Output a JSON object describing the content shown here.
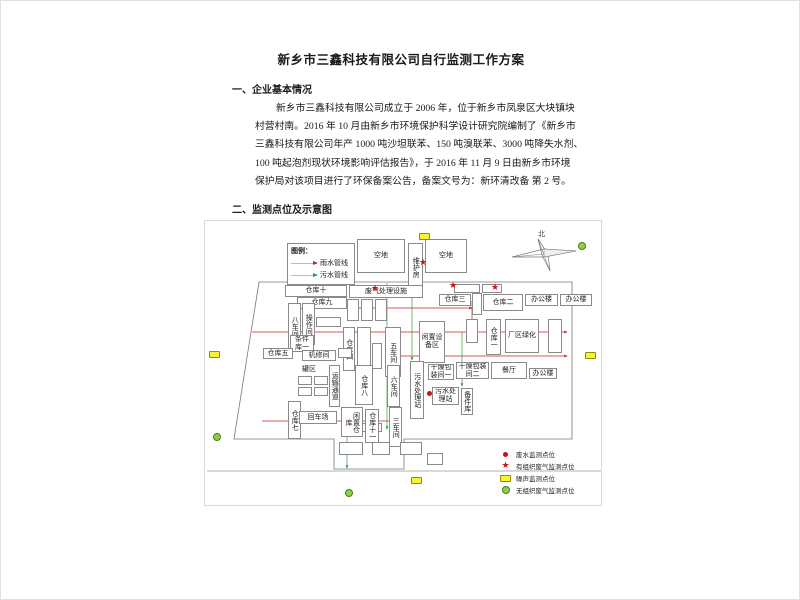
{
  "document": {
    "title": "新乡市三鑫科技有限公司自行监测工作方案",
    "section1_heading": "一、企业基本情况",
    "paragraph_lines": [
      "新乡市三鑫科技有限公司成立于 2006 年，位于新乡市凤泉区大块镇块",
      "村营村南。2016 年 10 月由新乡市环境保护科学设计研究院编制了《新乡市",
      "三鑫科技有限公司年产 1000 吨沙坦联苯、150 吨溴联苯、3000 吨降失水剂、",
      "100 吨起泡剂现状环境影响评估报告》，于 2016 年 11 月 9 日由新乡市环境",
      "保护局对该项目进行了环保备案公告，备案文号为：新环清改备 第 2 号。"
    ],
    "section2_heading": "二、监测点位及示意图"
  },
  "diagram": {
    "compass_label": "北",
    "legend_top": {
      "title": "图例：",
      "items": [
        {
          "label": "雨水管线",
          "color": "#cc2222"
        },
        {
          "label": "污水管线",
          "color": "#2f9e44"
        }
      ]
    },
    "legend_bottom": {
      "items": [
        {
          "type": "water",
          "label": "废水监测点位"
        },
        {
          "type": "org",
          "label": "有组织废气监测点位"
        },
        {
          "type": "noise",
          "label": "噪声监测点位"
        },
        {
          "type": "unorg",
          "label": "无组织废气监测点位"
        }
      ]
    },
    "colors": {
      "rain": "#cc2222",
      "sewage": "#2f9e44",
      "noise": "#f6f332",
      "unorg": "#8ed04a",
      "org": "#cc1111",
      "water": "#cc1111"
    },
    "outline": "54,61 367,61 367,218 199,218 199,248 129,248 129,218 29,218",
    "road_y": 250,
    "buildings": [
      {
        "l": "空地",
        "x": 152,
        "y": 18,
        "w": 48,
        "h": 34
      },
      {
        "l": "维护房",
        "x": 203,
        "y": 22,
        "w": 15,
        "h": 48,
        "v": 1
      },
      {
        "l": "空地",
        "x": 220,
        "y": 18,
        "w": 42,
        "h": 34
      },
      {
        "l": "仓库十",
        "x": 80,
        "y": 64,
        "w": 62,
        "h": 12
      },
      {
        "l": "废气处理设施",
        "x": 144,
        "y": 64,
        "w": 74,
        "h": 13
      },
      {
        "l": "",
        "x": 249,
        "y": 63,
        "w": 26,
        "h": 9
      },
      {
        "l": "",
        "x": 277,
        "y": 63,
        "w": 20,
        "h": 9
      },
      {
        "l": "仓库九",
        "x": 92,
        "y": 76,
        "w": 50,
        "h": 12
      },
      {
        "l": "仓库三",
        "x": 234,
        "y": 73,
        "w": 32,
        "h": 12
      },
      {
        "l": "",
        "x": 267,
        "y": 72,
        "w": 10,
        "h": 22,
        "v": 1
      },
      {
        "l": "仓库二",
        "x": 278,
        "y": 73,
        "w": 40,
        "h": 17
      },
      {
        "l": "办公楼",
        "x": 320,
        "y": 73,
        "w": 33,
        "h": 12
      },
      {
        "l": "办公楼",
        "x": 355,
        "y": 73,
        "w": 32,
        "h": 12
      },
      {
        "l": "八车间",
        "x": 83,
        "y": 82,
        "w": 13,
        "h": 46,
        "v": 1
      },
      {
        "l": "操作间",
        "x": 97,
        "y": 82,
        "w": 13,
        "h": 42,
        "v": 1
      },
      {
        "l": "",
        "x": 111,
        "y": 96,
        "w": 25,
        "h": 10
      },
      {
        "l": "",
        "x": 142,
        "y": 78,
        "w": 12,
        "h": 22
      },
      {
        "l": "",
        "x": 156,
        "y": 78,
        "w": 12,
        "h": 22
      },
      {
        "l": "",
        "x": 170,
        "y": 78,
        "w": 12,
        "h": 22
      },
      {
        "l": "仓库四",
        "x": 138,
        "y": 106,
        "w": 12,
        "h": 44,
        "v": 1
      },
      {
        "l": "",
        "x": 152,
        "y": 106,
        "w": 14,
        "h": 44,
        "v": 1
      },
      {
        "l": "五车间",
        "x": 180,
        "y": 106,
        "w": 16,
        "h": 50,
        "v": 1
      },
      {
        "l": "",
        "x": 167,
        "y": 122,
        "w": 10,
        "h": 26,
        "v": 1
      },
      {
        "l": "闲置设备区",
        "x": 214,
        "y": 100,
        "w": 26,
        "h": 42
      },
      {
        "l": "仓库一",
        "x": 281,
        "y": 98,
        "w": 15,
        "h": 36,
        "v": 1
      },
      {
        "l": "厂区绿化",
        "x": 300,
        "y": 98,
        "w": 34,
        "h": 34
      },
      {
        "l": "",
        "x": 261,
        "y": 98,
        "w": 12,
        "h": 24,
        "v": 1
      },
      {
        "l": "",
        "x": 343,
        "y": 98,
        "w": 14,
        "h": 34,
        "v": 1
      },
      {
        "l": "条件库一",
        "x": 85,
        "y": 114,
        "w": 24,
        "h": 17
      },
      {
        "l": "仓库五",
        "x": 58,
        "y": 127,
        "w": 30,
        "h": 11
      },
      {
        "l": "机修间",
        "x": 97,
        "y": 129,
        "w": 34,
        "h": 11
      },
      {
        "l": "",
        "x": 133,
        "y": 127,
        "w": 14,
        "h": 10
      },
      {
        "l": "罐区",
        "x": 93,
        "y": 144,
        "w": 22,
        "h": 10,
        "p": 1
      },
      {
        "l": "",
        "x": 93,
        "y": 155,
        "w": 14,
        "h": 9
      },
      {
        "l": "",
        "x": 109,
        "y": 155,
        "w": 14,
        "h": 9
      },
      {
        "l": "",
        "x": 93,
        "y": 166,
        "w": 14,
        "h": 9
      },
      {
        "l": "",
        "x": 109,
        "y": 166,
        "w": 14,
        "h": 9
      },
      {
        "l": "运输通道",
        "x": 124,
        "y": 144,
        "w": 11,
        "h": 42,
        "v": 1
      },
      {
        "l": "仓库八",
        "x": 150,
        "y": 144,
        "w": 18,
        "h": 40,
        "v": 1
      },
      {
        "l": "六车间",
        "x": 182,
        "y": 144,
        "w": 13,
        "h": 42,
        "v": 1
      },
      {
        "l": "污水处理站",
        "x": 205,
        "y": 140,
        "w": 14,
        "h": 58,
        "v": 1
      },
      {
        "l": "干燥包装间一",
        "x": 223,
        "y": 143,
        "w": 26,
        "h": 16
      },
      {
        "l": "干燥包装间二",
        "x": 251,
        "y": 141,
        "w": 33,
        "h": 17
      },
      {
        "l": "餐厅",
        "x": 286,
        "y": 141,
        "w": 36,
        "h": 17
      },
      {
        "l": "办公楼",
        "x": 324,
        "y": 147,
        "w": 28,
        "h": 11
      },
      {
        "l": "污水处理站",
        "x": 227,
        "y": 166,
        "w": 27,
        "h": 18
      },
      {
        "l": "备件库",
        "x": 256,
        "y": 167,
        "w": 12,
        "h": 27,
        "v": 1
      },
      {
        "l": "仓库七",
        "x": 83,
        "y": 180,
        "w": 13,
        "h": 38,
        "v": 1
      },
      {
        "l": "回车场",
        "x": 94,
        "y": 190,
        "w": 38,
        "h": 13
      },
      {
        "l": "",
        "x": 147,
        "y": 202,
        "w": 30,
        "h": 9
      },
      {
        "l": "闲置仓库",
        "x": 136,
        "y": 186,
        "w": 22,
        "h": 30,
        "v": 1
      },
      {
        "l": "仓库十一",
        "x": 160,
        "y": 188,
        "w": 14,
        "h": 34,
        "v": 1
      },
      {
        "l": "三车间",
        "x": 184,
        "y": 186,
        "w": 13,
        "h": 40,
        "v": 1
      },
      {
        "l": "",
        "x": 134,
        "y": 221,
        "w": 24,
        "h": 13
      },
      {
        "l": "",
        "x": 167,
        "y": 221,
        "w": 18,
        "h": 13
      },
      {
        "l": "",
        "x": 195,
        "y": 221,
        "w": 22,
        "h": 13
      },
      {
        "l": "",
        "x": 222,
        "y": 232,
        "w": 16,
        "h": 12
      }
    ],
    "markers": [
      {
        "t": "noise",
        "x": 214,
        "y": 12
      },
      {
        "t": "noise",
        "x": 4,
        "y": 130
      },
      {
        "t": "noise",
        "x": 380,
        "y": 131
      },
      {
        "t": "noise",
        "x": 206,
        "y": 256
      },
      {
        "t": "unorg",
        "x": 373,
        "y": 21
      },
      {
        "t": "unorg",
        "x": 8,
        "y": 212
      },
      {
        "t": "unorg",
        "x": 140,
        "y": 268
      },
      {
        "t": "org",
        "x": 166,
        "y": 64
      },
      {
        "t": "org",
        "x": 214,
        "y": 38
      },
      {
        "t": "org",
        "x": 286,
        "y": 63
      },
      {
        "t": "org",
        "x": 244,
        "y": 61
      },
      {
        "t": "water",
        "x": 222,
        "y": 170
      }
    ],
    "pipes": [
      {
        "c": "rain",
        "x1": 97,
        "y1": 87,
        "x2": 267,
        "y2": 87
      },
      {
        "c": "rain",
        "x1": 267,
        "y1": 80,
        "x2": 267,
        "y2": 111
      },
      {
        "c": "rain",
        "x1": 47,
        "y1": 111,
        "x2": 362,
        "y2": 111
      },
      {
        "c": "rain",
        "x1": 192,
        "y1": 135,
        "x2": 362,
        "y2": 135
      },
      {
        "c": "rain",
        "x1": 57,
        "y1": 200,
        "x2": 187,
        "y2": 200
      },
      {
        "c": "sewage",
        "x1": 182,
        "y1": 62,
        "x2": 182,
        "y2": 208
      },
      {
        "c": "sewage",
        "x1": 207,
        "y1": 72,
        "x2": 207,
        "y2": 139
      },
      {
        "c": "sewage",
        "x1": 257,
        "y1": 111,
        "x2": 257,
        "y2": 165
      },
      {
        "c": "sewage",
        "x1": 142,
        "y1": 210,
        "x2": 142,
        "y2": 247
      }
    ]
  }
}
